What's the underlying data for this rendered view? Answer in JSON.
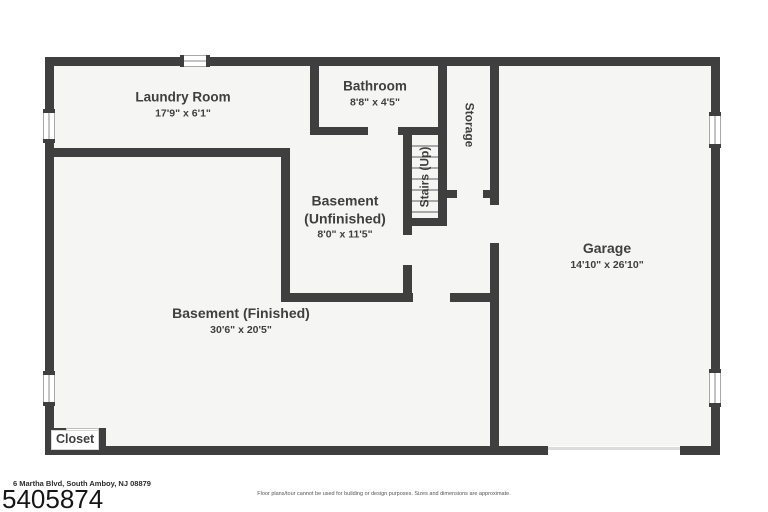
{
  "colors": {
    "wall": "#3f3f3f",
    "room_fill": "#f5f5f4",
    "label_text": "#3f3f3f",
    "garage_door_line": "#dcdcdc"
  },
  "rooms": {
    "laundry": {
      "name": "Laundry Room",
      "dims": "17'9\" x 6'1\""
    },
    "bathroom": {
      "name": "Bathroom",
      "dims": "8'8\" x 4'5\""
    },
    "storage": {
      "name": "Storage"
    },
    "stairs": {
      "name": "Stairs (Up)"
    },
    "basement_unfinished": {
      "line1": "Basement",
      "line2": "(Unfinished)",
      "dims": "8'0\" x 11'5\""
    },
    "garage": {
      "name": "Garage",
      "dims": "14'10\" x 26'10\""
    },
    "basement_finished": {
      "name": "Basement (Finished)",
      "dims": "30'6\" x 20'5\""
    },
    "closet": {
      "name": "Closet"
    }
  },
  "footer": {
    "address": "6 Martha Blvd, South Amboy, NJ 08879",
    "mls_number": "5405874",
    "disclaimer": "Floor plans/tour cannot be used for building or design purposes. Sizes and dimensions are approximate."
  }
}
